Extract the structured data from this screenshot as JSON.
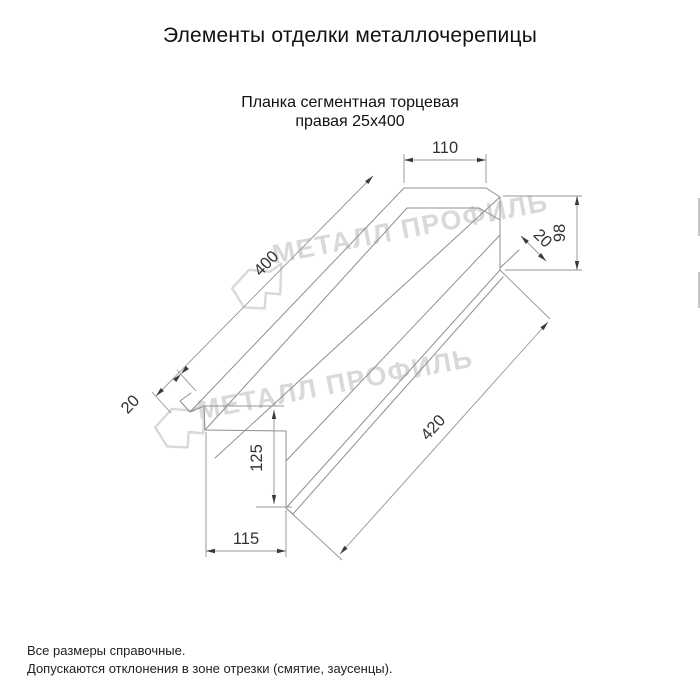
{
  "colors": {
    "line": "#949494",
    "edge": "#8f8f8f",
    "arrow": "#3a3a3a",
    "dim_text": "#333333",
    "title": "#111111",
    "note": "#222222",
    "watermark": "#d9d9d9",
    "bg": "#ffffff"
  },
  "header": {
    "title": "Элементы отделки металлочерепицы",
    "subtitle_line1": "Планка сегментная торцевая",
    "subtitle_line2": "правая 25х400"
  },
  "watermark": {
    "brand": "МЕТАЛЛ ПРОФИЛЬ"
  },
  "drawing": {
    "part_name": "Планка сегментная торцевая правая 25х400",
    "dimensions_mm": {
      "top_flat_width": "110",
      "right_end_height": "98",
      "right_hem": "20",
      "segment_length": "400",
      "tip_hem": "20",
      "left_end_height": "125",
      "left_end_depth": "115",
      "bottom_edge_length": "420"
    }
  },
  "notes": {
    "line1": "Все размеры справочные.",
    "line2": "Допускаются отклонения в зоне отрезки (смятие, заусенцы)."
  }
}
